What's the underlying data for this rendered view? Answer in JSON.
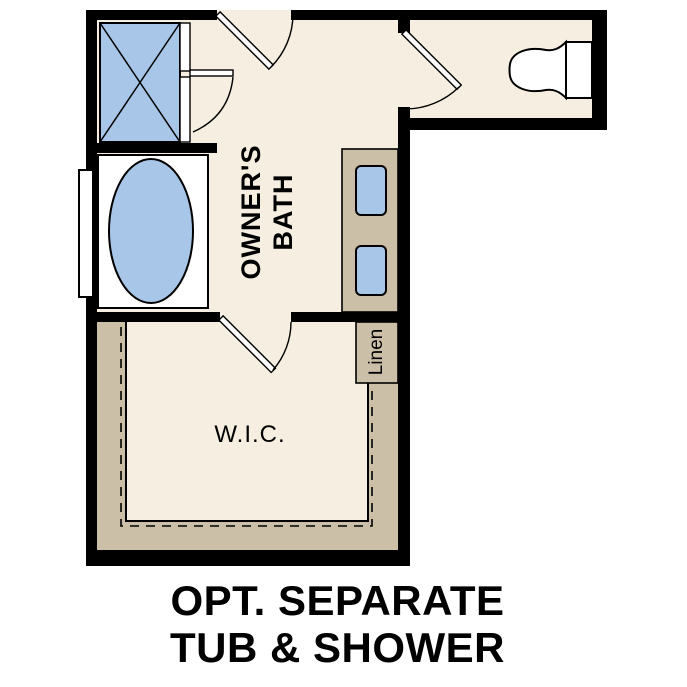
{
  "rooms": {
    "owners_bath_line1": "OWNER'S",
    "owners_bath_line2": "BATH",
    "wic": "W.I.C.",
    "linen": "Linen"
  },
  "caption": {
    "line1": "OPT. SEPARATE",
    "line2": "TUB & SHOWER"
  },
  "fixtures": {
    "shower": "shower-icon",
    "tub": "bathtub-icon",
    "toilet": "toilet-icon",
    "vanity_sinks": "sink-icon",
    "window": "window-icon",
    "doors": "door-swing-icon",
    "closet_rod": "closet-rod-dashed-line"
  },
  "colors": {
    "background": "#ffffff",
    "wall": "#000000",
    "floor": "#f5eee1",
    "cabinet": "#cbbfa8",
    "fixture": "#a8c7e8",
    "line": "#000000"
  }
}
